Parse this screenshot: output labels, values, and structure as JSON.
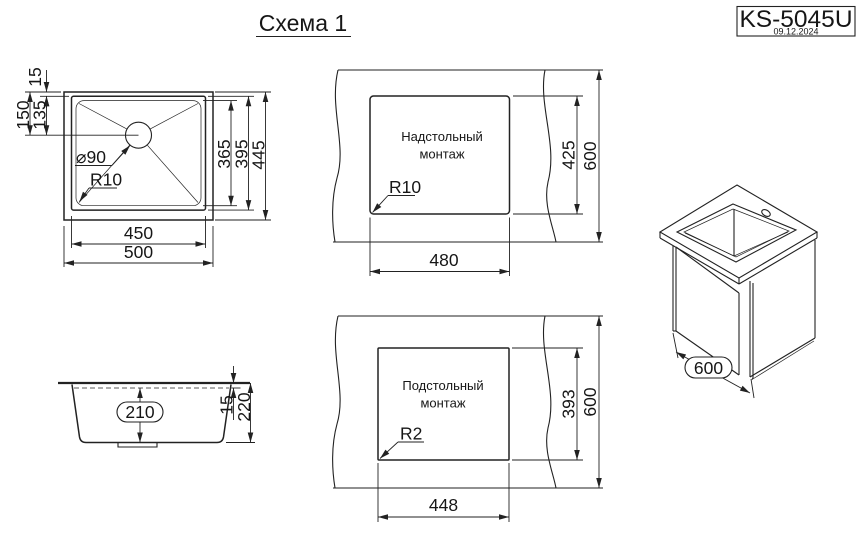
{
  "title": "Схема 1",
  "title_block": {
    "model": "KS-5045U",
    "date": "09.12.2024"
  },
  "colors": {
    "line": "#222222",
    "background": "#ffffff"
  },
  "top_view": {
    "offset_top": "15",
    "center_from_top": "150",
    "center_from_bowl_top": "135",
    "height_inner": "365",
    "height_bowl": "395",
    "height_overall": "445",
    "width_bowl": "450",
    "width_overall": "500",
    "drain": "⌀90",
    "radius": "R10"
  },
  "overmount": {
    "label1": "Надстольный",
    "label2": "монтаж",
    "cutout_height": "425",
    "counter_depth": "600",
    "cutout_width": "480",
    "radius": "R10"
  },
  "undermount": {
    "label1": "Подстольный",
    "label2": "монтаж",
    "cutout_height": "393",
    "counter_depth": "600",
    "cutout_width": "448",
    "radius": "R2"
  },
  "side_view": {
    "depth_inner": "210",
    "flange": "15",
    "depth_overall": "220"
  },
  "iso_view": {
    "depth": "600"
  }
}
